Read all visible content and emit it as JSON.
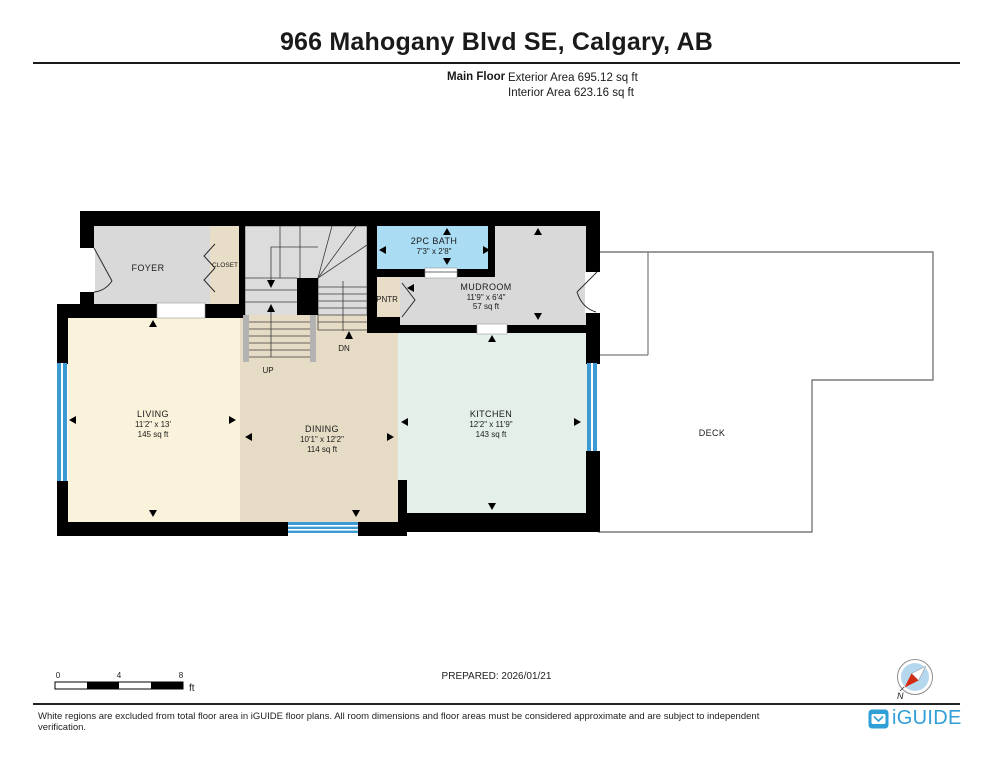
{
  "header": {
    "title": "966 Mahogany Blvd SE, Calgary, AB",
    "floor_label": "Main Floor",
    "exterior_area": "Exterior Area 695.12 sq ft",
    "interior_area": "Interior Area 623.16 sq ft"
  },
  "rooms": {
    "foyer": {
      "name": "FOYER"
    },
    "closet": {
      "name": "CLOSET"
    },
    "bath": {
      "name": "2PC BATH",
      "dims": "7'3\" x 2'8\""
    },
    "pantry": {
      "name": "PNTR"
    },
    "mudroom": {
      "name": "MUDROOM",
      "dims": "11'9\" x 6'4\"",
      "area": "57 sq ft"
    },
    "living": {
      "name": "LIVING",
      "dims": "11'2\" x 13'",
      "area": "145 sq ft"
    },
    "dining": {
      "name": "DINING",
      "dims": "10'1\" x 12'2\"",
      "area": "114 sq ft"
    },
    "kitchen": {
      "name": "KITCHEN",
      "dims": "12'2\" x 11'9\"",
      "area": "143 sq ft"
    },
    "deck": {
      "name": "DECK"
    }
  },
  "stairs": {
    "up_label": "UP",
    "down_label": "DN"
  },
  "scale_bar": {
    "tick0": "0",
    "tick4": "4",
    "tick8": "8",
    "unit": "ft"
  },
  "prepared_label": "PREPARED: 2026/01/21",
  "compass": {
    "north_label": "N"
  },
  "footer": {
    "disclaimer": "White regions are excluded from total floor area in iGUIDE floor plans. All room dimensions and floor areas must be considered approximate and are subject to independent verification.",
    "logo_text": "iGUIDE"
  },
  "colors": {
    "wall": "#000000",
    "window_blue": "#3d9ad2",
    "bath_floor": "#aadcf4",
    "living_floor": "#faf2da",
    "dining_floor": "#e6dcc6",
    "kitchen_floor": "#e4efe9",
    "mudroom_floor": "#d9d9d9",
    "foyer_floor": "#d9d9d9",
    "closet_floor": "#e8ddc6",
    "pantry_floor": "#e8ddc6",
    "stairs_floor": "#dcdcdc",
    "deck_outline": "#7a7a7a",
    "brand_blue": "#2f9fd6",
    "compass_fill": "#b5d8ee",
    "needle_red": "#d42a10"
  }
}
